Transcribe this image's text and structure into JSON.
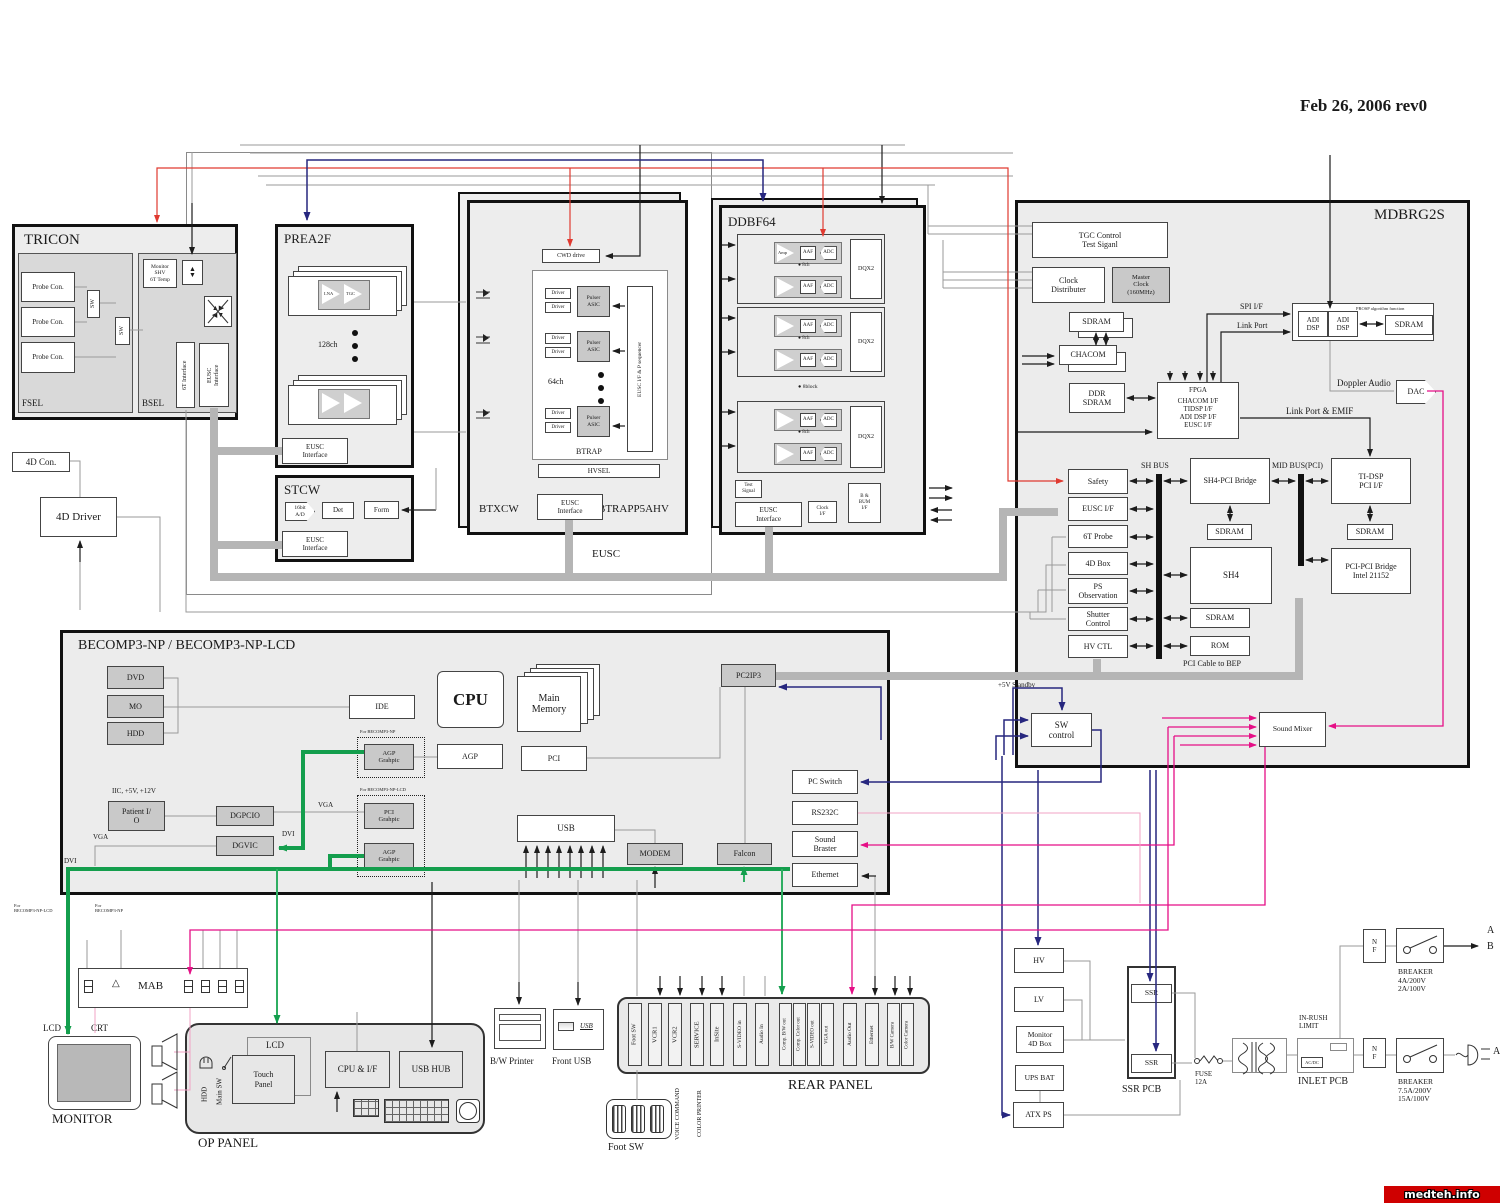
{
  "header": {
    "date": "Feb 26, 2006   rev0",
    "watermark": "medteh.info"
  },
  "tricon": {
    "title": "TRICON",
    "fsel": "FSEL",
    "bsel": "BSEL",
    "probe_con": "Probe Con.",
    "sw": "SW",
    "monitor": "Monitor\nSHV\n6T Temp",
    "if6t": "6T Interface",
    "eusc_if": "EUSC\nInterface"
  },
  "prea2f": {
    "title": "PREA2F",
    "ch": "128ch",
    "lna": "LNA",
    "tgc": "TGC",
    "eusc_if": "EUSC\nInterface"
  },
  "stcw": {
    "title": "STCW",
    "ad": "16bit\nA/D",
    "det": "Det",
    "form": "Form",
    "eusc_if": "EUSC\nInterface"
  },
  "fourd": {
    "con": "4D Con.",
    "driver": "4D Driver"
  },
  "eusc": {
    "label": "EUSC",
    "btxcw": "BTXCW",
    "btrapp": "BTRAPP5AHV",
    "btrap": "BTRAP",
    "hvsel": "HVSEL",
    "cwd": "CWD drive",
    "driver": "Driver",
    "pulser": "Pulser\nASIC",
    "ch": "64ch",
    "seq": "EUSC I/F & P sequencer",
    "eusc_if": "EUSC\nInterface"
  },
  "ddbf": {
    "title": "DDBF64",
    "amp": "Amp",
    "aaf": "AAF",
    "adc": "ADC",
    "ch8": "8ch",
    "block8": "8block",
    "dqx2": "DQX2",
    "test": "Test\nSignal",
    "clock": "Clock\nI/F",
    "bbum": "B &\nBUM\nI/F",
    "eusc_if": "EUSC\nInterface"
  },
  "mdbrg": {
    "title": "MDBRG2S",
    "tgc": "TGC Control\nTest Siganl",
    "clock_dist": "Clock\nDistributer",
    "master_clock": "Master\nClock\n(160MHz)",
    "sdram": "SDRAM",
    "chacom": "CHACOM",
    "ddr": "DDR\nSDRAM",
    "fpga_title": "FPGA",
    "fpga_lines": "CHACOM I/F\nTIDSP I/F\nADI DSP I/F\nEUSC I/F",
    "spi": "SPI I/F",
    "link_port": "Link Port",
    "adi": "ADI\nDSP",
    "prosp": "PROSP algorithm function",
    "doppler": "Doppler Audio",
    "dac": "DAC",
    "emif": "Link Port & EMIF",
    "safety": "Safety",
    "eusc_if": "EUSC I/F",
    "probe6t": "6T Probe",
    "box4d": "4D Box",
    "psobs": "PS\nObservation",
    "shutter": "Shutter\nControl",
    "hvctl": "HV CTL",
    "shbus": "SH BUS",
    "sh4pci": "SH4-PCI Bridge",
    "sh4": "SH4",
    "rom": "ROM",
    "midbus": "MID BUS(PCI)",
    "tidsp": "TI-DSP\nPCI I/F",
    "pcipci": "PCI-PCI Bridge\nIntel 21152",
    "pcicable": "PCI Cable to BEP",
    "mixer": "Sound Mixer"
  },
  "swctl": {
    "label": "SW\ncontrol",
    "standby": "+5V Standby"
  },
  "becomp": {
    "title": "BECOMP3-NP   /   BECOMP3-NP-LCD",
    "dvd": "DVD",
    "mo": "MO",
    "hdd": "HDD",
    "ide": "IDE",
    "cpu": "CPU",
    "mainmem": "Main\nMemory",
    "agp": "AGP",
    "pci": "PCI",
    "usb": "USB",
    "patient": "Patient I/\nO",
    "iic": "IIC, +5V, +12V",
    "dgpcio": "DGPCIO",
    "dgvic": "DGVIC",
    "for_np": "For  BECOMP3-NP",
    "for_lcd": "For  BECOMP3-NP-LCD",
    "agp_g": "AGP\nGrahpic",
    "pci_g": "PCI\nGrahpic",
    "modem": "MODEM",
    "falcon": "Falcon",
    "pc2ip3": "PC2IP3",
    "pcswitch": "PC Switch",
    "rs232c": "RS232C",
    "sndbraster": "Sound\nBraster",
    "ethernet": "Ethernet",
    "vga": "VGA",
    "dvi": "DVI"
  },
  "console": {
    "mab": "MAB",
    "lcd": "LCD",
    "crt": "CRT",
    "mic": "Mic",
    "monitor": "MONITOR",
    "oppanel": "OP PANEL",
    "hdd": "HDD",
    "mainsw": "Main SW",
    "lcdbox": "LCD",
    "touch": "Touch\nPanel",
    "cpuif": "CPU & I/F",
    "usbhub": "USB HUB"
  },
  "periph": {
    "bwprinter": "B/W Printer",
    "frontusb": "Front USB",
    "usb": "USB",
    "rear": "REAR PANEL",
    "ports": [
      "Foot SW",
      "VCR1",
      "VCR2",
      "SERVICE",
      "InSite",
      "S-VIDEO in",
      "Audio In",
      "Comp. B/W out",
      "Comp. Color out",
      "S-VIDEO out",
      "VGA out",
      "Audio Out",
      "Ethernet",
      "B/W Camera",
      "Color Camera"
    ],
    "voice": "VOICE COMMAND",
    "colorprinter": "COLOR PRINTER",
    "footsw": "Foot SW"
  },
  "power": {
    "hv": "HV",
    "lv": "LV",
    "mon4d": "Monitor\n4D Box",
    "ups": "UPS BAT",
    "atx": "ATX PS",
    "ssr": "SSR",
    "ssrpcb": "SSR PCB",
    "fuse": "FUSE\n12A",
    "inrush": "IN-RUSH\nLIMIT",
    "inlet": "INLET PCB",
    "acdc": "AC/DC",
    "nf": "N\nF",
    "brk1": "BREAKER\n4A/200V\n2A/100V",
    "brk2": "BREAKER\n7.5A/200V\n15A/100V",
    "a": "A",
    "b": "B"
  }
}
